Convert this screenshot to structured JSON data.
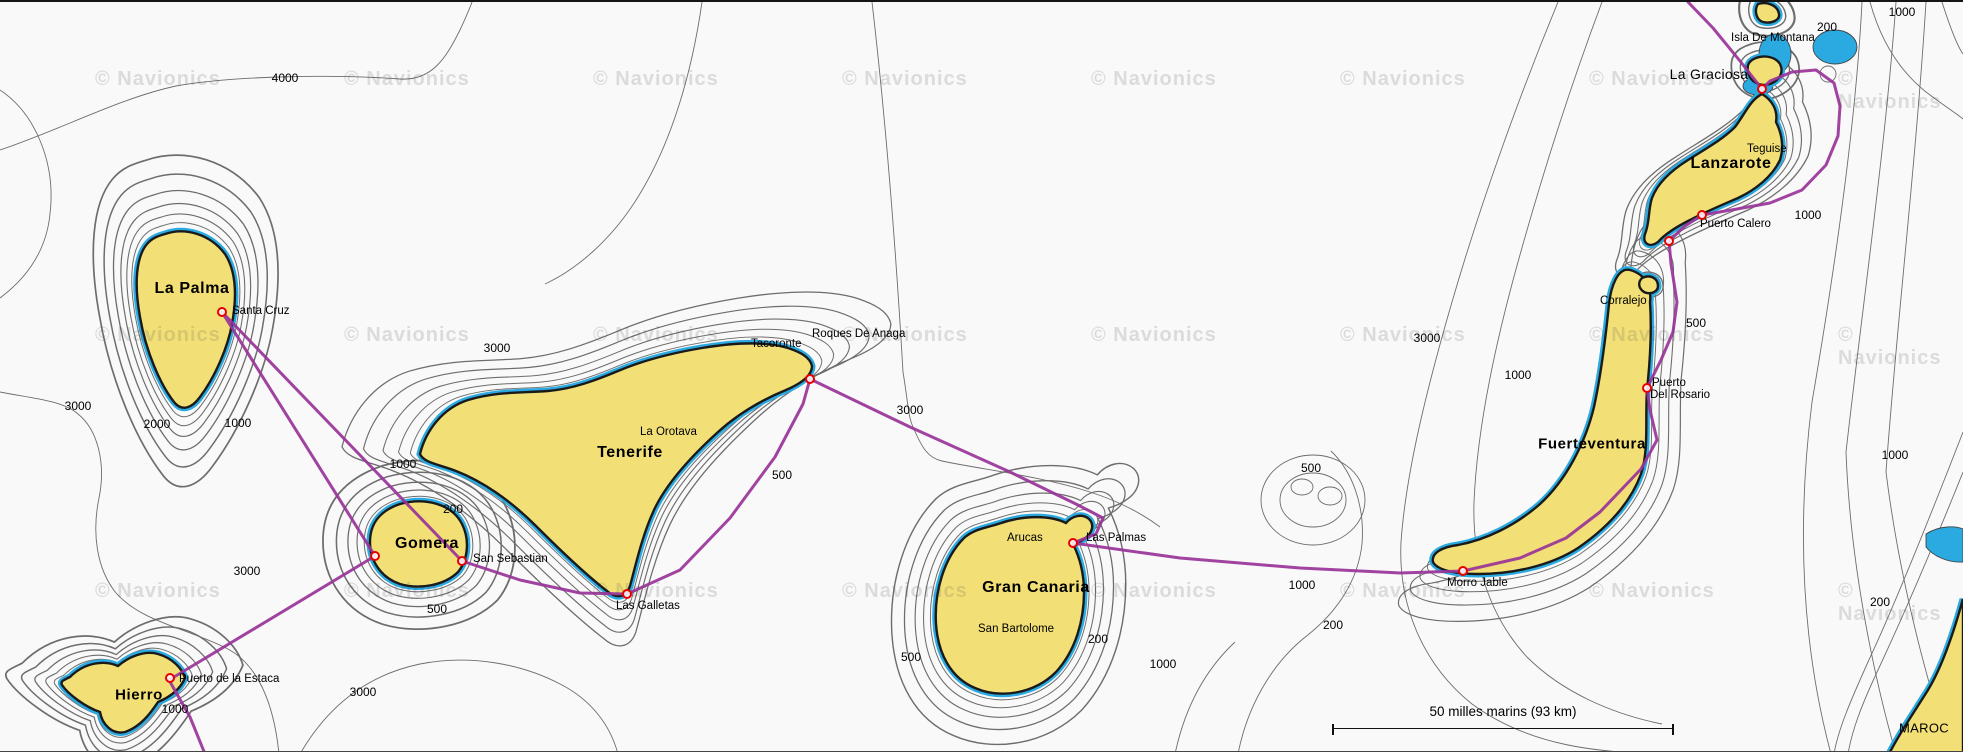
{
  "attribution": {
    "text": "© Navionics"
  },
  "watermark_grid": {
    "cols": [
      95,
      344,
      593,
      842,
      1091,
      1340,
      1589,
      1838
    ],
    "rows": [
      66,
      322,
      578
    ]
  },
  "scale_bar": {
    "label": "50 milles marins (93 km)"
  },
  "colors": {
    "land": "#F2E077",
    "shallow_water": "#2BA9E1",
    "deep_water": "#F9F9F9",
    "route": "#993399",
    "port_marker": "#E60000",
    "contour": "#555555"
  },
  "island_labels": [
    {
      "text": "La Palma",
      "x": 192,
      "y": 287,
      "size": 16,
      "bold": true
    },
    {
      "text": "Hierro",
      "x": 139,
      "y": 693,
      "size": 15,
      "bold": true
    },
    {
      "text": "Gomera",
      "x": 427,
      "y": 542,
      "size": 16,
      "bold": true
    },
    {
      "text": "Tenerife",
      "x": 630,
      "y": 451,
      "size": 16,
      "bold": true
    },
    {
      "text": "Gran Canaria",
      "x": 1036,
      "y": 586,
      "size": 16,
      "bold": true
    },
    {
      "text": "Fuerteventura",
      "x": 1592,
      "y": 442,
      "size": 15,
      "bold": true
    },
    {
      "text": "Lanzarote",
      "x": 1731,
      "y": 162,
      "size": 16,
      "bold": true
    },
    {
      "text": "La Graciosa",
      "x": 1709,
      "y": 72,
      "size": 14,
      "bold": false
    },
    {
      "text": "MAROC",
      "x": 1924,
      "y": 726,
      "size": 13,
      "bold": false
    }
  ],
  "port_labels": [
    {
      "text": "Santa Cruz",
      "x": 232,
      "y": 309
    },
    {
      "text": "Puerto de la Estaca",
      "x": 179,
      "y": 677
    },
    {
      "text": "San Sebastian",
      "x": 473,
      "y": 557
    },
    {
      "text": "Las Galletas",
      "x": 616,
      "y": 604
    },
    {
      "text": "Arucas",
      "x": 1007,
      "y": 536
    },
    {
      "text": "Las Palmas",
      "x": 1086,
      "y": 536
    },
    {
      "text": "San Bartolome",
      "x": 978,
      "y": 627
    },
    {
      "text": "Morro Jable",
      "x": 1447,
      "y": 581
    },
    {
      "text": "Puerto",
      "x": 1652,
      "y": 381
    },
    {
      "text": "Del Rosario",
      "x": 1650,
      "y": 393
    },
    {
      "text": "Corralejo",
      "x": 1600,
      "y": 299
    },
    {
      "text": "Puerto Calero",
      "x": 1700,
      "y": 222
    },
    {
      "text": "Teguise",
      "x": 1747,
      "y": 147
    },
    {
      "text": "Isla De Montana",
      "x": 1731,
      "y": 36
    },
    {
      "text": "Tacoronte",
      "x": 751,
      "y": 342
    },
    {
      "text": "Roques De Anaga",
      "x": 812,
      "y": 332
    },
    {
      "text": "La Orotava",
      "x": 640,
      "y": 430
    }
  ],
  "port_markers": [
    {
      "name": "santa-cruz",
      "x": 222,
      "y": 310
    },
    {
      "name": "gomera-west",
      "x": 375,
      "y": 554
    },
    {
      "name": "san-sebastian",
      "x": 462,
      "y": 559
    },
    {
      "name": "puerto-de-la-estaca",
      "x": 170,
      "y": 676
    },
    {
      "name": "las-galletas",
      "x": 627,
      "y": 592
    },
    {
      "name": "roques-de-anaga",
      "x": 810,
      "y": 377
    },
    {
      "name": "las-palmas",
      "x": 1073,
      "y": 541
    },
    {
      "name": "morro-jable",
      "x": 1463,
      "y": 569
    },
    {
      "name": "puerto-del-rosario",
      "x": 1647,
      "y": 386
    },
    {
      "name": "puerto-calero",
      "x": 1702,
      "y": 213
    },
    {
      "name": "lanzarote-south",
      "x": 1669,
      "y": 239
    },
    {
      "name": "la-graciosa-strait",
      "x": 1762,
      "y": 87
    }
  ],
  "depth_labels": [
    {
      "text": "4000",
      "x": 285,
      "y": 76
    },
    {
      "text": "3000",
      "x": 78,
      "y": 404
    },
    {
      "text": "2000",
      "x": 157,
      "y": 422
    },
    {
      "text": "1000",
      "x": 238,
      "y": 421
    },
    {
      "text": "3000",
      "x": 247,
      "y": 569
    },
    {
      "text": "3000",
      "x": 363,
      "y": 690
    },
    {
      "text": "1000",
      "x": 175,
      "y": 707
    },
    {
      "text": "1000",
      "x": 403,
      "y": 462
    },
    {
      "text": "200",
      "x": 453,
      "y": 507
    },
    {
      "text": "500",
      "x": 437,
      "y": 607
    },
    {
      "text": "3000",
      "x": 497,
      "y": 346
    },
    {
      "text": "500",
      "x": 782,
      "y": 473
    },
    {
      "text": "3000",
      "x": 910,
      "y": 408
    },
    {
      "text": "500",
      "x": 911,
      "y": 655
    },
    {
      "text": "200",
      "x": 1098,
      "y": 637
    },
    {
      "text": "1000",
      "x": 1163,
      "y": 662
    },
    {
      "text": "1000",
      "x": 1302,
      "y": 583
    },
    {
      "text": "200",
      "x": 1333,
      "y": 623
    },
    {
      "text": "500",
      "x": 1311,
      "y": 466
    },
    {
      "text": "3000",
      "x": 1427,
      "y": 336
    },
    {
      "text": "1000",
      "x": 1518,
      "y": 373
    },
    {
      "text": "500",
      "x": 1696,
      "y": 321
    },
    {
      "text": "1000",
      "x": 1808,
      "y": 213
    },
    {
      "text": "1000",
      "x": 1902,
      "y": 10
    },
    {
      "text": "200",
      "x": 1827,
      "y": 25
    },
    {
      "text": "1000",
      "x": 1895,
      "y": 453
    },
    {
      "text": "200",
      "x": 1880,
      "y": 600
    }
  ]
}
